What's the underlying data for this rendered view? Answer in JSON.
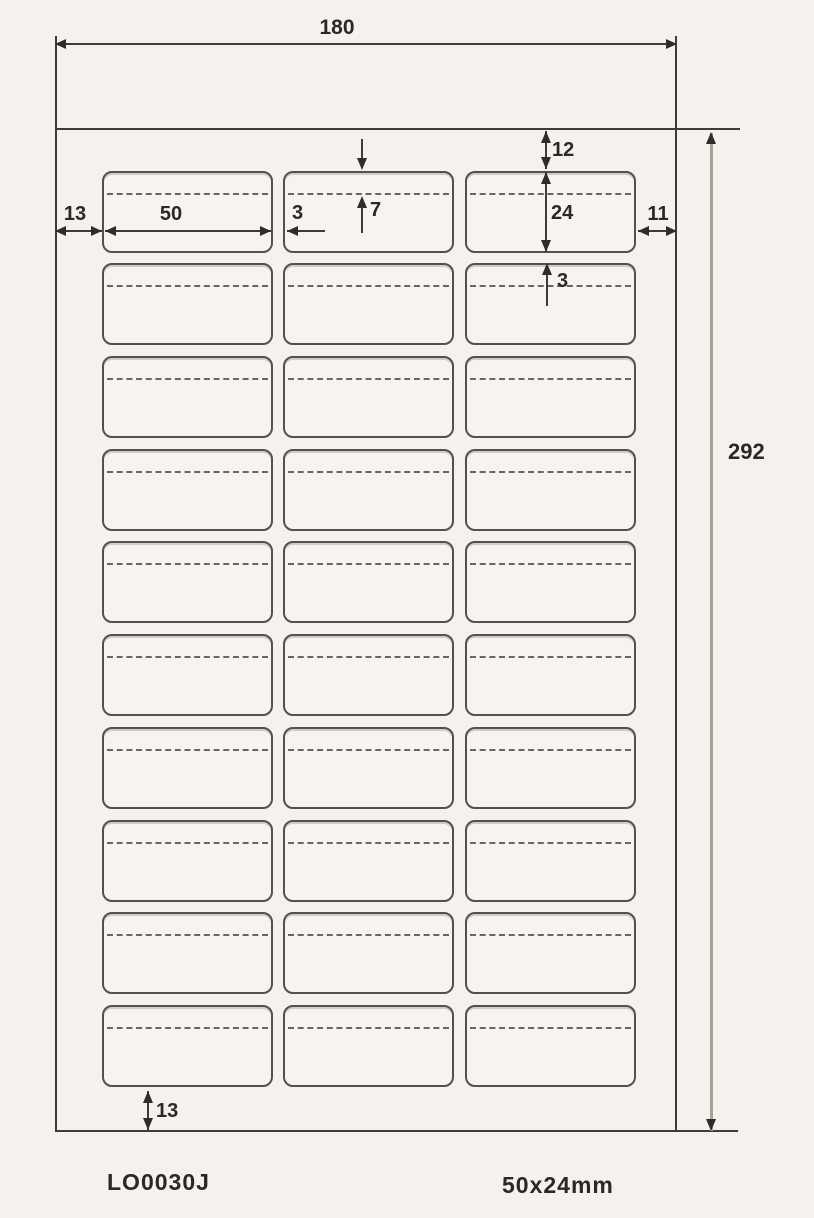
{
  "diagram": {
    "title_hint": "label sheet dimension drawing",
    "dimensions": {
      "sheet_width": "180",
      "sheet_height": "292",
      "margin_left": "13",
      "label_width": "50",
      "horizontal_gap": "3",
      "dash_line_offset": "7",
      "margin_top": "12",
      "label_height": "24",
      "margin_right": "11",
      "vertical_gap": "3",
      "margin_bottom": "13"
    },
    "grid": {
      "rows": 10,
      "columns": 3
    },
    "footer": {
      "product_code": "LO0030J",
      "label_size": "50x24mm"
    },
    "colors": {
      "ink": "#3f3b37",
      "background": "#f5f2ed",
      "height_dim_line": "#a8a29b"
    }
  }
}
